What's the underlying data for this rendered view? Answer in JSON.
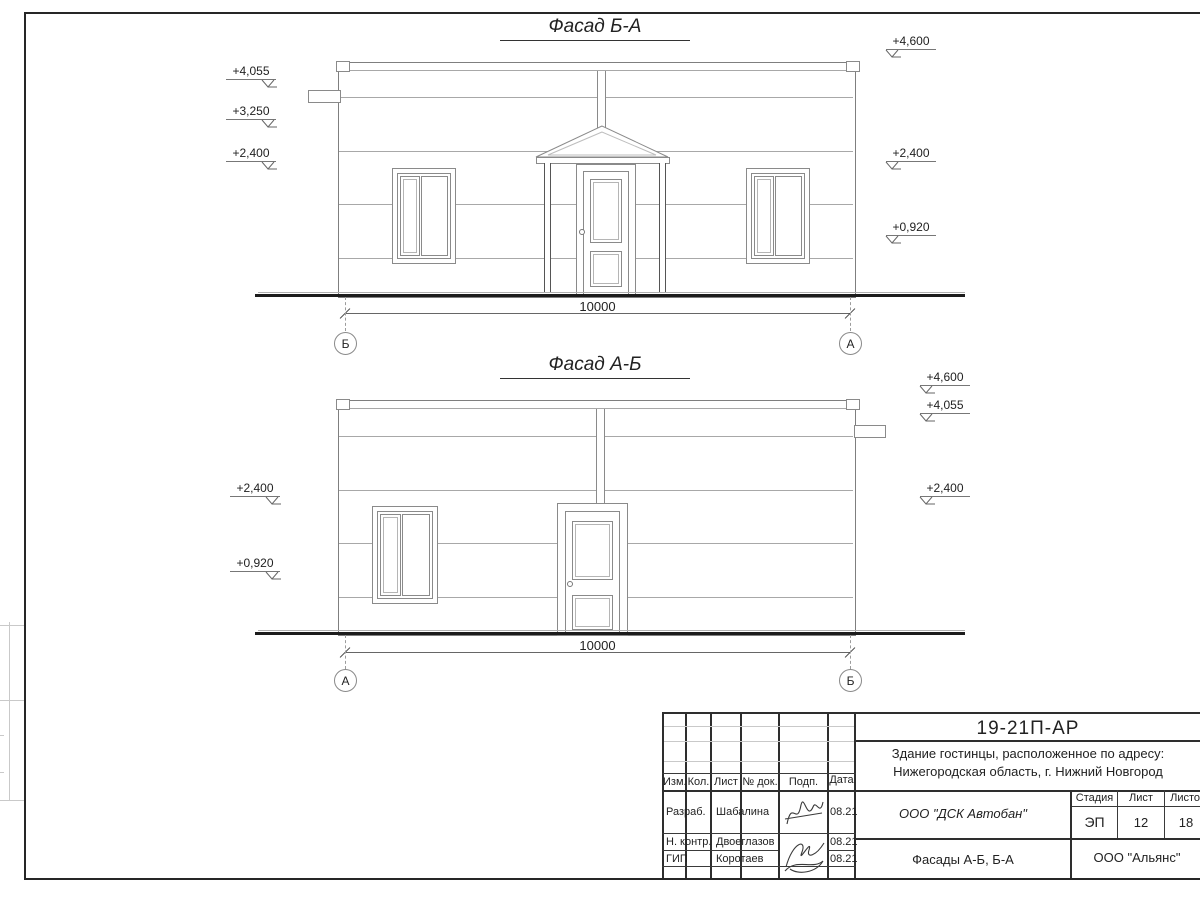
{
  "facades": {
    "f1": {
      "title": "Фасад Б-А",
      "left_marks": [
        "+4,055",
        "+3,250",
        "+2,400"
      ],
      "right_marks": [
        "+4,600",
        "+2,400",
        "+0,920"
      ],
      "dimension": "10000",
      "axis_left": "Б",
      "axis_right": "А"
    },
    "f2": {
      "title": "Фасад А-Б",
      "left_marks": [
        "+2,400",
        "+0,920"
      ],
      "right_marks": [
        "+4,600",
        "+4,055",
        "+2,400"
      ],
      "dimension": "10000",
      "axis_left": "А",
      "axis_right": "Б"
    }
  },
  "title_block": {
    "doc_code": "19-21П-АР",
    "object_line1": "Здание гостинцы, расположенное по адресу:",
    "object_line2": "Нижегородская область, г. Нижний Новгород",
    "rev_headers": [
      "Изм.",
      "Кол.",
      "Лист",
      "№ док.",
      "Подп.",
      "Дата"
    ],
    "roles": [
      {
        "role": "Разраб.",
        "name": "Шабалина",
        "date": "08.21"
      },
      {
        "role": "Н. контр.",
        "name": "Двоеглазов",
        "date": "08.21"
      },
      {
        "role": "ГИП",
        "name": "Коротаев",
        "date": "08.21"
      }
    ],
    "company": "ООО \"ДСК Автобан\"",
    "stage_label": "Стадия",
    "sheet_label": "Лист",
    "sheets_label": "Листов",
    "stage": "ЭП",
    "sheet_no": "12",
    "sheets_total": "18",
    "drawing_title": "Фасады А-Б, Б-А",
    "org": "ООО \"Альянс\""
  },
  "colors": {
    "line": "#8a8a8a",
    "frame": "#262626",
    "ground": "#1c1c1c"
  }
}
